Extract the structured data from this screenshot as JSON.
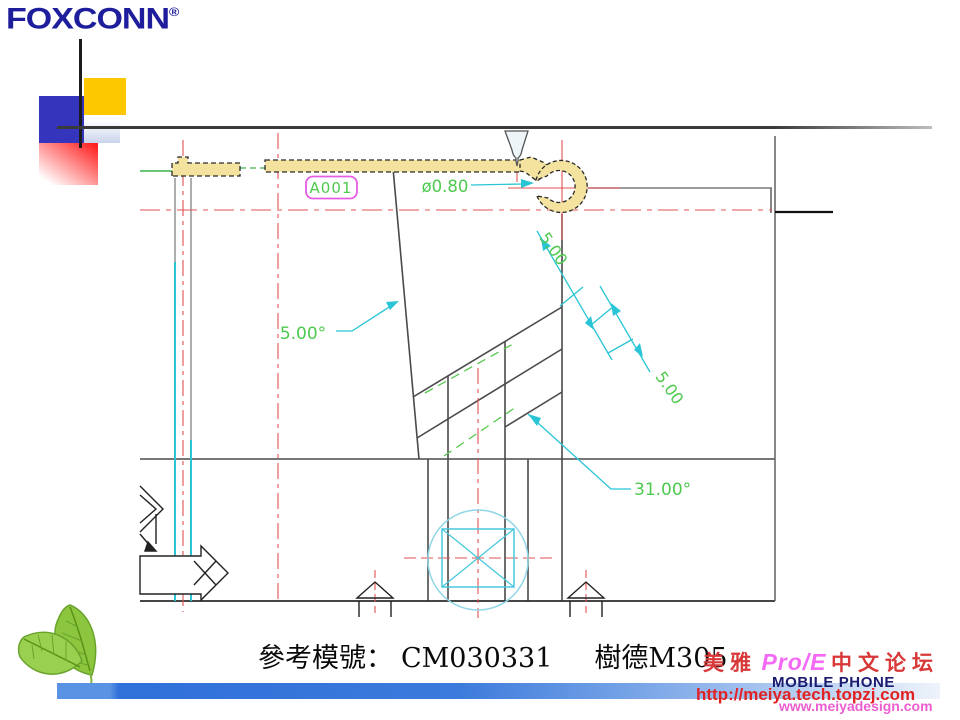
{
  "logo": {
    "text": "FOXCONN",
    "registered_mark": "®"
  },
  "footer": {
    "reference_label": "參考模號：",
    "model_number": "CM030331",
    "maker_model": "樹德M305"
  },
  "watermark": {
    "brand_cn_left": "美雅",
    "brand_en": "Pro/E",
    "brand_cn_right": "中文论坛",
    "line2": "MOBILE PHONE",
    "url1": "http://meiya.tech.topzj.com",
    "url2": "www.meiyadesign.com"
  },
  "drawing": {
    "balloon_label": "A001",
    "dimensions": {
      "gate_diameter": "ø0.80",
      "draft_angle": "5.00°",
      "step_depth_1": "5.00",
      "step_depth_2": "5.00",
      "stair_angle": "31.00°"
    },
    "colors": {
      "part_fill": "#f3e39e",
      "centerline_red": "#e05353",
      "dimension_cyan": "#29c5d6",
      "dim_text_green": "#4ec94e",
      "balloon_border_magenta": "#e55ce5",
      "structure_gray": "#4a4a4a"
    }
  },
  "deco_colors": {
    "logo_navy": "#1e1e9c",
    "square_yellow": "#fec801",
    "square_blue": "#3434bd",
    "square_red": "#ff2222",
    "bar_blue": "#2f70d9"
  }
}
